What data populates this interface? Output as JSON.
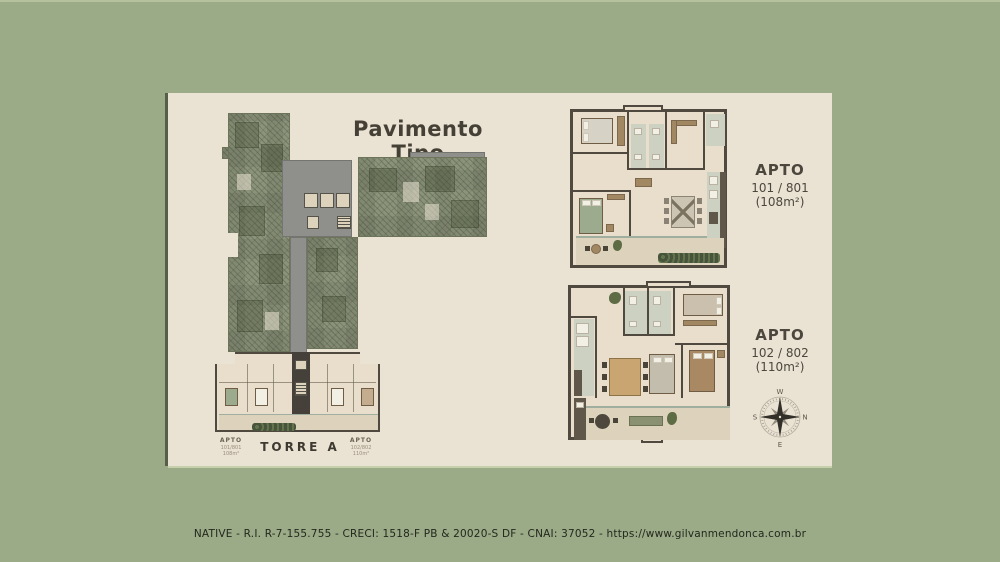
{
  "title": "Pavimento Tipo",
  "tower": {
    "name": "TORRE A",
    "apartments": [
      {
        "label": "APTO",
        "units": "101/801",
        "area": "108m²"
      },
      {
        "label": "APTO",
        "units": "102/802",
        "area": "110m²"
      }
    ]
  },
  "plans": [
    {
      "label": "APTO",
      "units": "101 / 801",
      "area": "(108m²)"
    },
    {
      "label": "APTO",
      "units": "102 / 802",
      "area": "(110m²)"
    }
  ],
  "compass": {
    "top": "W",
    "right": "N",
    "bottom": "E",
    "left": "S"
  },
  "footer": "NATIVE - R.I. R-7-155.755 - CRECI: 1518-F PB & 20020-S DF - CNAI: 37052 - https://www.gilvanmendonca.com.br",
  "colors": {
    "bg": "#9baa87",
    "panel": "#eae3d4",
    "roof": "#8b937a",
    "roofline": "#6c755a",
    "gray": "#8f8f8b",
    "wall": "#4f4940",
    "floor": "#e9decb",
    "bath": "#cdd1c1",
    "wood": "#a28862",
    "hedge": "#57653f",
    "ink": "#454036",
    "footer": "#23281d"
  }
}
